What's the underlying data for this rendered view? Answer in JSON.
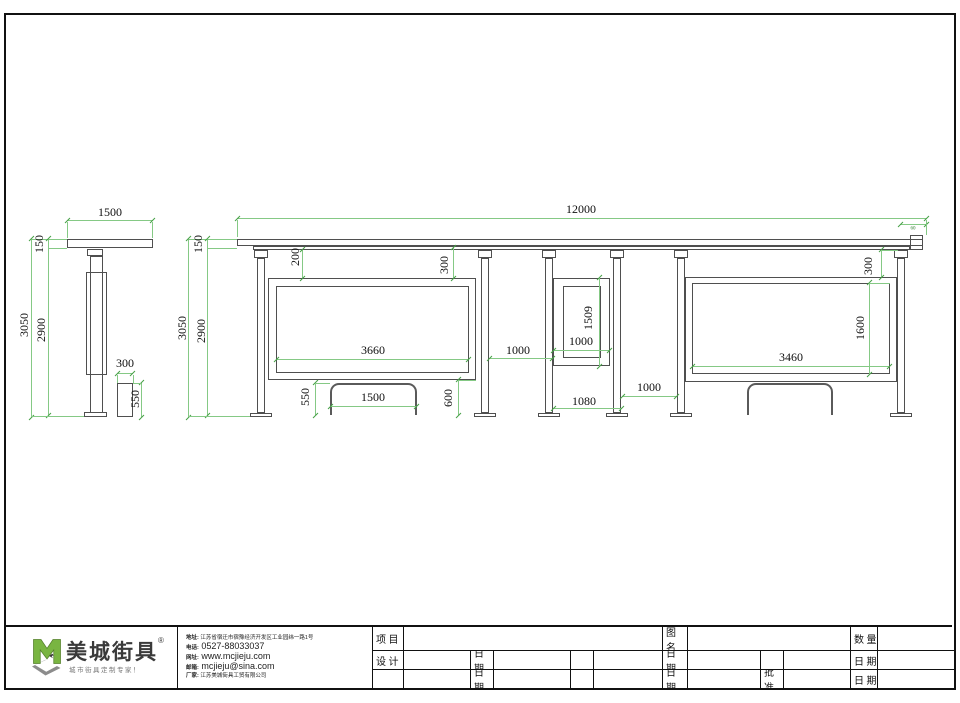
{
  "side_view": {
    "width": "1500",
    "roof_height": "150",
    "total_height": "3050",
    "post_height": "2900",
    "bin_width": "300",
    "bin_height": "550"
  },
  "front_view": {
    "total_width": "12000",
    "roof_height": "150",
    "total_height": "3050",
    "post_height": "2900",
    "roof_drop": "200",
    "panel1_top_gap": "300",
    "panel1_width": "3660",
    "gap1": "1000",
    "bench1_height": "550",
    "bench1_width": "1500",
    "panel1_bottom_gap": "600",
    "panel2_width": "1000",
    "panel2_height": "1509",
    "mid_bay": "1080",
    "gap2": "1000",
    "panel3_top_gap": "300",
    "panel3_height": "1600",
    "panel3_width": "3460",
    "roof_end": "60"
  },
  "title_block": {
    "brand": "美城街具",
    "reg_mark": "®",
    "tagline": "城市街具定制专家！",
    "contact": {
      "address_label": "地址:",
      "address": "江苏省宿迁市宿豫经济开发区工业园纬一路1号",
      "phone_label": "电话:",
      "phone": "0527-88033037",
      "web_label": "网址:",
      "web": "www.mcjieju.com",
      "email_label": "邮箱:",
      "email": "mcjieju@sina.com",
      "company_label": "厂家:",
      "company": "江苏美城街具工贸有限公司"
    },
    "fields": {
      "project": "项 目",
      "design": "设 计",
      "date": "日 期",
      "drawing_name": "图 名",
      "quantity": "数 量",
      "approve": "批 准"
    }
  }
}
